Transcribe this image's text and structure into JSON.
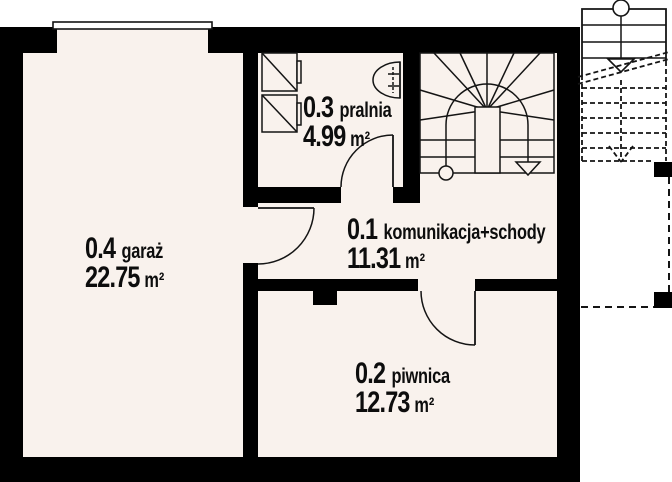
{
  "plan": {
    "type": "floor-plan",
    "rooms": [
      {
        "number": "0.4",
        "name": "garaż",
        "area": "22.75",
        "unit": "m²"
      },
      {
        "number": "0.3",
        "name": "pralnia",
        "area": "4.99",
        "unit": "m²"
      },
      {
        "number": "0.1",
        "name": "komunikacja+schody",
        "area": "11.31",
        "unit": "m²"
      },
      {
        "number": "0.2",
        "name": "piwnica",
        "area": "12.73",
        "unit": "m²"
      }
    ],
    "symbols": [
      "washing-machine-icon",
      "washbasin-icon",
      "window",
      "door-swing",
      "stair-walk-line-circle",
      "stair-walk-line-arrow"
    ],
    "colors": {
      "wall": "#000000",
      "floor": "#f9f2ed",
      "background": "#ffffff",
      "line": "#141414"
    }
  }
}
